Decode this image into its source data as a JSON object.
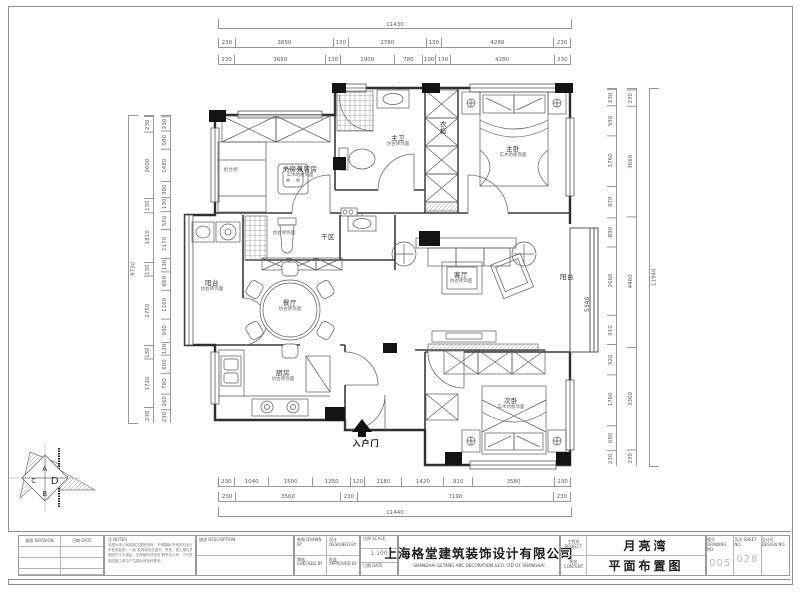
{
  "plan": {
    "rooms": [
      {
        "main": "书房兼客房",
        "sub": "实木地板饰面"
      },
      {
        "main": "组合柜",
        "sub": ""
      },
      {
        "main": "主卫",
        "sub": "仿古砖饰面"
      },
      {
        "main": "衣柜",
        "sub": ""
      },
      {
        "main": "主卧",
        "sub": "实木地板饰面"
      },
      {
        "main": "",
        "sub": "仿古砖饰面"
      },
      {
        "main": "干区",
        "sub": ""
      },
      {
        "main": "阳台",
        "sub": "仿古砖饰面"
      },
      {
        "main": "餐厅",
        "sub": "仿古砖饰面"
      },
      {
        "main": "客厅",
        "sub": "仿古砖饰面"
      },
      {
        "main": "阳台",
        "sub": ""
      },
      {
        "main": "厨房",
        "sub": "仿古砖饰面"
      },
      {
        "main": "次卧",
        "sub": "实木地板饰面"
      }
    ],
    "entry_label": "入户门",
    "balcony_dim": "5340"
  },
  "dims": {
    "top_overall": "11430",
    "top_row1": [
      {
        "t": "230",
        "w": 230
      },
      {
        "t": "3650",
        "w": 3650
      },
      {
        "t": "130",
        "w": 130
      },
      {
        "t": "2780",
        "w": 2780
      },
      {
        "t": "130",
        "w": 130
      },
      {
        "t": "4280",
        "w": 4280
      },
      {
        "t": "230",
        "w": 230
      }
    ],
    "top_row2": [
      {
        "t": "230",
        "w": 230
      },
      {
        "t": "3650",
        "w": 3650
      },
      {
        "t": "130",
        "w": 130
      },
      {
        "t": "1900",
        "w": 1900
      },
      {
        "t": "780",
        "w": 780
      },
      {
        "t": "100",
        "w": 100
      },
      {
        "t": "130",
        "w": 130
      },
      {
        "t": "4280",
        "w": 4280
      },
      {
        "t": "230",
        "w": 230
      }
    ],
    "bottom_row1": [
      {
        "t": "230",
        "w": 230
      },
      {
        "t": "1040",
        "w": 1040
      },
      {
        "t": "1500",
        "w": 1500
      },
      {
        "t": "1250",
        "w": 1250
      },
      {
        "t": "120",
        "w": 120
      },
      {
        "t": "1180",
        "w": 1180
      },
      {
        "t": "1420",
        "w": 1420
      },
      {
        "t": "910",
        "w": 910
      },
      {
        "t": "3560",
        "w": 3560
      },
      {
        "t": "230",
        "w": 230
      }
    ],
    "bottom_row2": [
      {
        "t": "230",
        "w": 230
      },
      {
        "t": "3560",
        "w": 3560
      },
      {
        "t": "230",
        "w": 230
      },
      {
        "t": "7190",
        "w": 7190
      },
      {
        "t": "230",
        "w": 230
      }
    ],
    "bottom_overall": "11440",
    "left_overall": "9730",
    "left_outer": [
      {
        "t": "230",
        "w": 230
      },
      {
        "t": "2600",
        "w": 2600
      },
      {
        "t": "130",
        "w": 130
      },
      {
        "t": "1810",
        "w": 1810
      },
      {
        "t": "130",
        "w": 130
      },
      {
        "t": "2750",
        "w": 2750
      },
      {
        "t": "130",
        "w": 130
      },
      {
        "t": "1720",
        "w": 1720
      },
      {
        "t": "230",
        "w": 230
      }
    ],
    "left_inner": [
      {
        "t": "230",
        "w": 230
      },
      {
        "t": "580",
        "w": 580
      },
      {
        "t": "1480",
        "w": 1480
      },
      {
        "t": "380",
        "w": 380
      },
      {
        "t": "130",
        "w": 130
      },
      {
        "t": "550",
        "w": 550
      },
      {
        "t": "1170",
        "w": 1170
      },
      {
        "t": "130",
        "w": 130
      },
      {
        "t": "660",
        "w": 660
      },
      {
        "t": "1160",
        "w": 1160
      },
      {
        "t": "930",
        "w": 930
      },
      {
        "t": "130",
        "w": 130
      },
      {
        "t": "600",
        "w": 600
      },
      {
        "t": "780",
        "w": 780
      },
      {
        "t": "260",
        "w": 260
      },
      {
        "t": "230",
        "w": 230
      }
    ],
    "right_inner": [
      {
        "t": "230",
        "w": 230
      },
      {
        "t": "930",
        "w": 930
      },
      {
        "t": "1760",
        "w": 1760
      },
      {
        "t": "970",
        "w": 970
      },
      {
        "t": "890",
        "w": 890
      },
      {
        "t": "2660",
        "w": 2660
      },
      {
        "t": "910",
        "w": 910
      },
      {
        "t": "920",
        "w": 920
      },
      {
        "t": "1760",
        "w": 1760
      },
      {
        "t": "680",
        "w": 680
      },
      {
        "t": "230",
        "w": 230
      }
    ],
    "right_mid": [
      {
        "t": "230",
        "w": 230
      },
      {
        "t": "3660",
        "w": 3660
      },
      {
        "t": "4460",
        "w": 4460
      },
      {
        "t": "3360",
        "w": 3360
      },
      {
        "t": "230",
        "w": 230
      }
    ],
    "right_overall": "11940"
  },
  "titleblock": {
    "revision_label": "修改  REVISION",
    "date_label": "日期  DATE",
    "notes_label": "注  NOTES",
    "notes_lines": [
      "本图为本公司绘制之图纸资料，不得翻版    所有权归本公司，未经许",
      "可使用复制，一经    发现将依法追究：责任，施工单位须仔细核对",
      "图纸尺寸无误后，如有疑问请及时    联系本公司，方可施工，",
      "若因施工单位产生疑问请及时联系。"
    ],
    "desc_label": "描述  DESCRIPTION",
    "drawn_label": "制图  DRAWN BY",
    "designed_label": "设计  DESIGNED BY",
    "scale_label": "比例  SCALE",
    "scale_value": "1:100",
    "checked_label": "审核  CHECKED BY",
    "approved_label": "批准  APPROVED BY",
    "date2_label": "日期  DATE",
    "company_cn": "上海格堂建筑装饰设计有限公司",
    "company_en": "SHANGHAI GETANG ARC DECORATION  &CO. LTD OF SHANGHAI",
    "project_label": "工程名 PROJECT",
    "project_value": "月亮湾",
    "content_label": "图名 CONTENT",
    "content_value": "平面布置图",
    "drawing_no_label": "图号 DRAWING NO.",
    "drawing_no": "005",
    "sheet_no_label": "页次 SHEET NO.",
    "sheet_no": "028",
    "design_no_label": "设计号 DESIGN NO.",
    "design_no": ""
  },
  "logo": {
    "letters": [
      "A",
      "C",
      "D",
      "B"
    ]
  }
}
